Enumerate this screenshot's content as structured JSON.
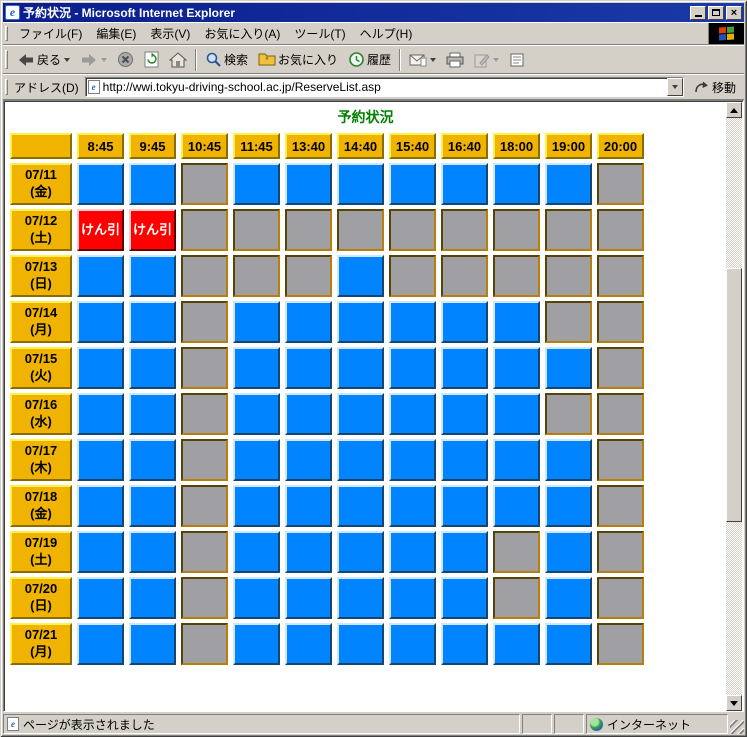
{
  "window": {
    "title": "予約状況 - Microsoft Internet Explorer"
  },
  "menu_bar": {
    "items": [
      "ファイル(F)",
      "編集(E)",
      "表示(V)",
      "お気に入り(A)",
      "ツール(T)",
      "ヘルプ(H)"
    ]
  },
  "toolbar": {
    "back_label": "戻る",
    "search_label": "検索",
    "favorites_label": "お気に入り",
    "history_label": "履歴"
  },
  "address_bar": {
    "label": "アドレス(D)",
    "url": "http://wwi.tokyu-driving-school.ac.jp/ReserveList.asp",
    "go_label": "移動"
  },
  "content": {
    "heading": "予約状況",
    "table": {
      "time_headers": [
        "8:45",
        "9:45",
        "10:45",
        "11:45",
        "13:40",
        "14:40",
        "15:40",
        "16:40",
        "18:00",
        "19:00",
        "20:00"
      ],
      "red_cell_label": "けん引",
      "rows": [
        {
          "date": "07/11",
          "day": "(金)",
          "cells": [
            "blue",
            "blue",
            "gray",
            "blue",
            "blue",
            "blue",
            "blue",
            "blue",
            "blue",
            "blue",
            "gray"
          ]
        },
        {
          "date": "07/12",
          "day": "(土)",
          "cells": [
            "red",
            "red",
            "gray",
            "gray",
            "gray",
            "gray",
            "gray",
            "gray",
            "gray",
            "gray",
            "gray"
          ]
        },
        {
          "date": "07/13",
          "day": "(日)",
          "cells": [
            "blue",
            "blue",
            "gray",
            "gray",
            "gray",
            "blue",
            "gray",
            "gray",
            "gray",
            "gray",
            "gray"
          ]
        },
        {
          "date": "07/14",
          "day": "(月)",
          "cells": [
            "blue",
            "blue",
            "gray",
            "blue",
            "blue",
            "blue",
            "blue",
            "blue",
            "blue",
            "gray",
            "gray"
          ]
        },
        {
          "date": "07/15",
          "day": "(火)",
          "cells": [
            "blue",
            "blue",
            "gray",
            "blue",
            "blue",
            "blue",
            "blue",
            "blue",
            "blue",
            "blue",
            "gray"
          ]
        },
        {
          "date": "07/16",
          "day": "(水)",
          "cells": [
            "blue",
            "blue",
            "gray",
            "blue",
            "blue",
            "blue",
            "blue",
            "blue",
            "blue",
            "gray",
            "gray"
          ]
        },
        {
          "date": "07/17",
          "day": "(木)",
          "cells": [
            "blue",
            "blue",
            "gray",
            "blue",
            "blue",
            "blue",
            "blue",
            "blue",
            "blue",
            "blue",
            "gray"
          ]
        },
        {
          "date": "07/18",
          "day": "(金)",
          "cells": [
            "blue",
            "blue",
            "gray",
            "blue",
            "blue",
            "blue",
            "blue",
            "blue",
            "blue",
            "blue",
            "gray"
          ]
        },
        {
          "date": "07/19",
          "day": "(土)",
          "cells": [
            "blue",
            "blue",
            "gray",
            "blue",
            "blue",
            "blue",
            "blue",
            "blue",
            "gray",
            "blue",
            "gray"
          ]
        },
        {
          "date": "07/20",
          "day": "(日)",
          "cells": [
            "blue",
            "blue",
            "gray",
            "blue",
            "blue",
            "blue",
            "blue",
            "blue",
            "gray",
            "blue",
            "gray"
          ]
        },
        {
          "date": "07/21",
          "day": "(月)",
          "cells": [
            "blue",
            "blue",
            "gray",
            "blue",
            "blue",
            "blue",
            "blue",
            "blue",
            "blue",
            "blue",
            "gray"
          ]
        }
      ]
    }
  },
  "status_bar": {
    "message": "ページが表示されました",
    "zone_label": "インターネット"
  },
  "colors": {
    "available_blue": "#0084FF",
    "unavailable_gray": "#A0A0A4",
    "towing_red": "#FF0000",
    "header_gold": "#F0B400",
    "heading_green": "#008000",
    "titlebar_navy": "#0A1E8C"
  }
}
